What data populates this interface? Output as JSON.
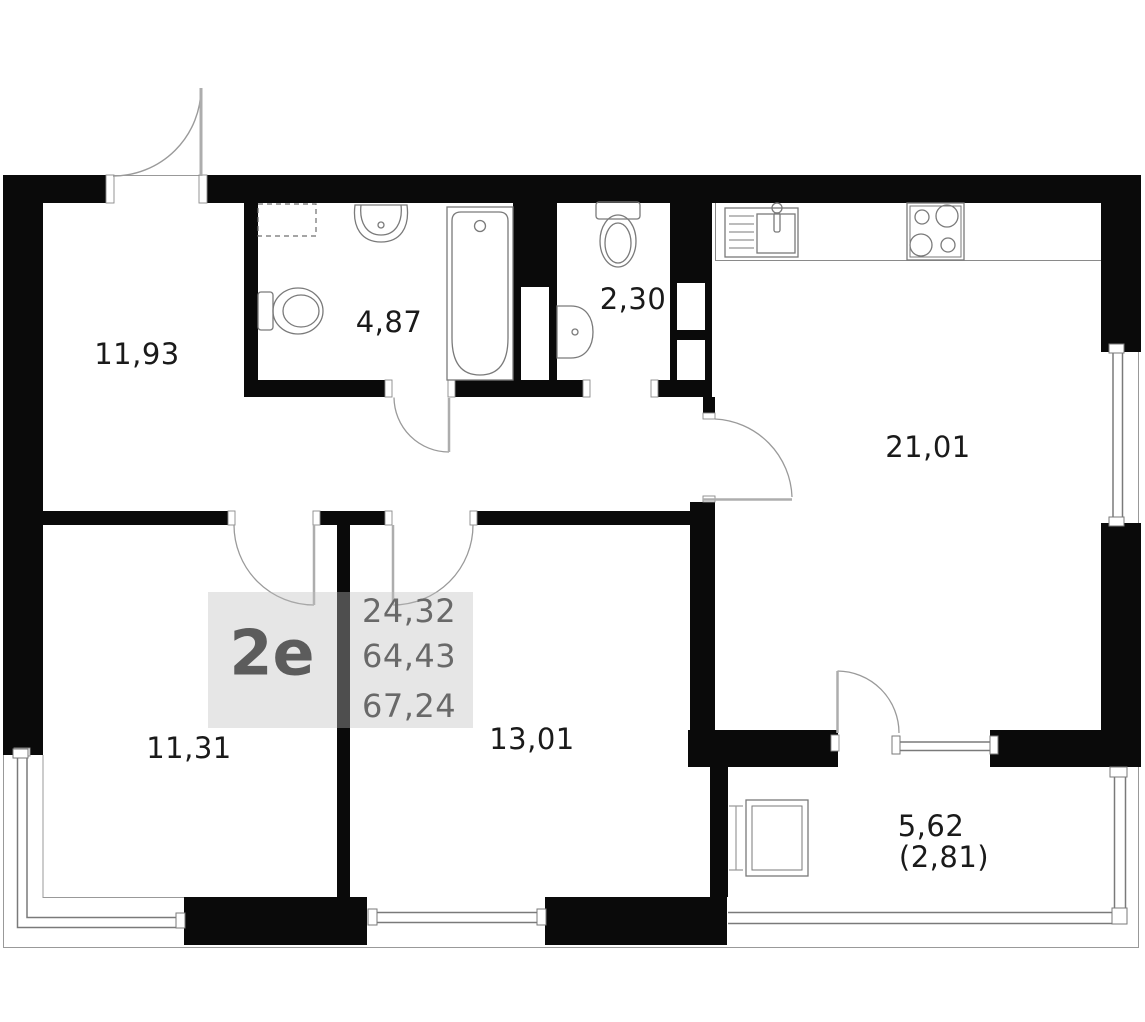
{
  "plan": {
    "unit_label": "2e",
    "area_summary": {
      "living_area": "24,32",
      "apartment_area": "64,43",
      "total_area": "67,24"
    },
    "rooms": {
      "hallway": {
        "area": "11,93"
      },
      "bathroom": {
        "area": "4,87"
      },
      "wc": {
        "area": "2,30"
      },
      "kitchen_living": {
        "area": "21,01"
      },
      "bedroom_left": {
        "area": "11,31"
      },
      "bedroom_middle": {
        "area": "13,01"
      },
      "balcony": {
        "area": "5,62",
        "area_reduced": "(2,81)"
      }
    },
    "colors": {
      "wall": "#0a0a0a",
      "outline": "#8a8a8a",
      "fixture_line": "#7a7a7a",
      "room_label_text": "#1a1a1a",
      "unit_label_text": "#5c5c5c",
      "summary_text": "#696969",
      "label_block_bg": "rgba(190,190,190,0.38)"
    }
  }
}
